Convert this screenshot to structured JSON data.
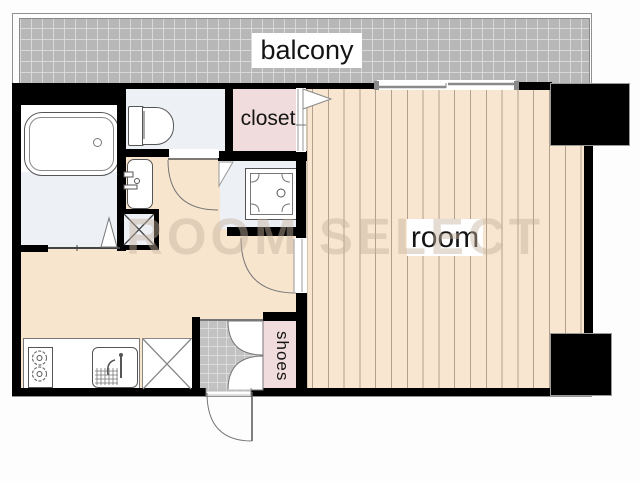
{
  "floorplan": {
    "labels": {
      "balcony": "balcony",
      "closet": "closet",
      "room": "room",
      "shoes": "shoes"
    },
    "watermark": "ROOM SELECT",
    "colors": {
      "wall": "#000000",
      "wood_floor": "#f8e6d0",
      "hall_floor": "#f8e5ce",
      "balcony_gray": "#b7b7b7",
      "tile_gray": "#c2c2c2",
      "closet_pink": "#f1dcdd",
      "wet_area_blue": "#edf1f6",
      "watermark_tan": "rgba(197,178,157,0.45)"
    }
  }
}
